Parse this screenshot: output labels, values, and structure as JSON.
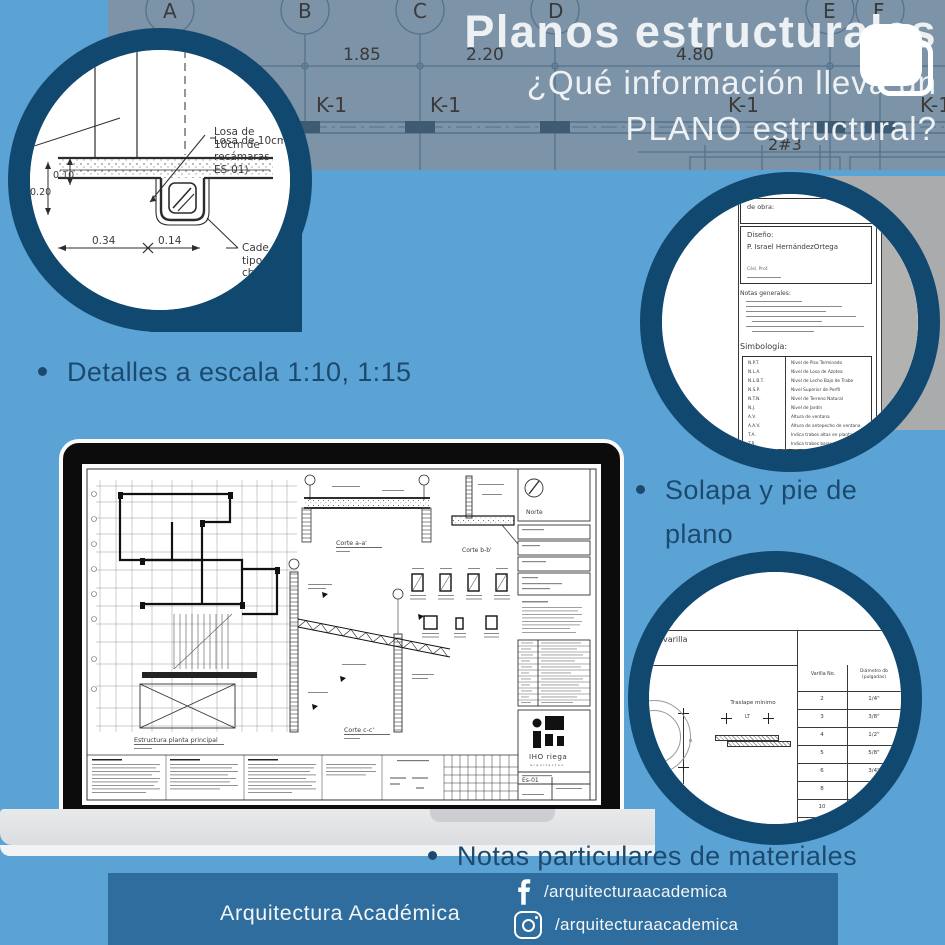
{
  "header": {
    "title": "Planos estructurales",
    "subtitle_line1": "¿Qué información lleva un",
    "subtitle_line2": "PLANO estructural?"
  },
  "background_drawing": {
    "grid_letters": [
      "A",
      "B",
      "C",
      "D",
      "E",
      "F"
    ],
    "dim_1": "1.85",
    "dim_2": "2.20",
    "dim_3": "4.80",
    "beam_label": "K-1",
    "rebar_note": "2#3"
  },
  "bullets": {
    "b1": "Detalles a escala 1:10, 1:15",
    "b2": "Solapa y pie de plano",
    "b3": "Notas particulares de materiales"
  },
  "detail_circle": {
    "note_losa": "Losa de\n10cm de\nrecámaras\nES-01)",
    "note_cadena": "Cade\ntipo\nch",
    "dim_height": "0.20",
    "dim_slab": "0.10",
    "dim_w1": "0.34",
    "dim_w2": "0.14"
  },
  "solapa_circle": {
    "field_obra": "de obra:",
    "field_diseno": "Diseño:",
    "designer": "P. Israel HernándezOrtega",
    "cedula_line": "Céd. Prof.",
    "notas_title": "Notas generales:",
    "simbologia_title": "Simbología:",
    "symbols": [
      {
        "abbr": "N.P.T.",
        "desc": "Nivel de Piso Terminado"
      },
      {
        "abbr": "N.L.A.",
        "desc": "Nivel de Losa de Azotea"
      },
      {
        "abbr": "N.L.B.T.",
        "desc": "Nivel de Lecho Bajo de Trabe"
      },
      {
        "abbr": "N.S.P.",
        "desc": "Nivel Superior de Perfil"
      },
      {
        "abbr": "N.T.N.",
        "desc": "Nivel de Terreno Natural"
      },
      {
        "abbr": "N.J.",
        "desc": "Nivel de Jardín"
      },
      {
        "abbr": "A.V.",
        "desc": "Altura de ventana"
      },
      {
        "abbr": "A.A.V.",
        "desc": "Altura de antepecho de ventana"
      },
      {
        "abbr": "T.A.",
        "desc": "Indica trabes altas en planta"
      },
      {
        "abbr": "T.B.",
        "desc": "Indica trabes bajas en planta"
      }
    ]
  },
  "varilla_circle": {
    "label_varilla": "varilla",
    "label_traslape": "Traslape mínimo",
    "label_lt": "LT",
    "label_e": "e",
    "col_varilla": "Varilla No.",
    "col_diametro": "Diámetro db (pulgadas)",
    "rows": [
      [
        "2",
        "1/4\""
      ],
      [
        "3",
        "3/8\""
      ],
      [
        "4",
        "1/2\""
      ],
      [
        "5",
        "5/8\""
      ],
      [
        "6",
        "3/4\""
      ],
      [
        "8",
        ""
      ],
      [
        "10",
        ""
      ]
    ]
  },
  "laptop_sheet": {
    "plan_caption": "Estructura planta principal",
    "corte_a": "Corte a-a'",
    "corte_b": "Corte b-b'",
    "corte_c": "Corte c-c'",
    "norte_label": "Norte",
    "logo_text": "IHO riega",
    "logo_sub": "arquitectos",
    "sheet_no": "Es-01"
  },
  "footer": {
    "brand": "Arquitectura Académica",
    "facebook_handle": "/arquitecturaacademica",
    "instagram_handle": "/arquitecturaacademica"
  }
}
